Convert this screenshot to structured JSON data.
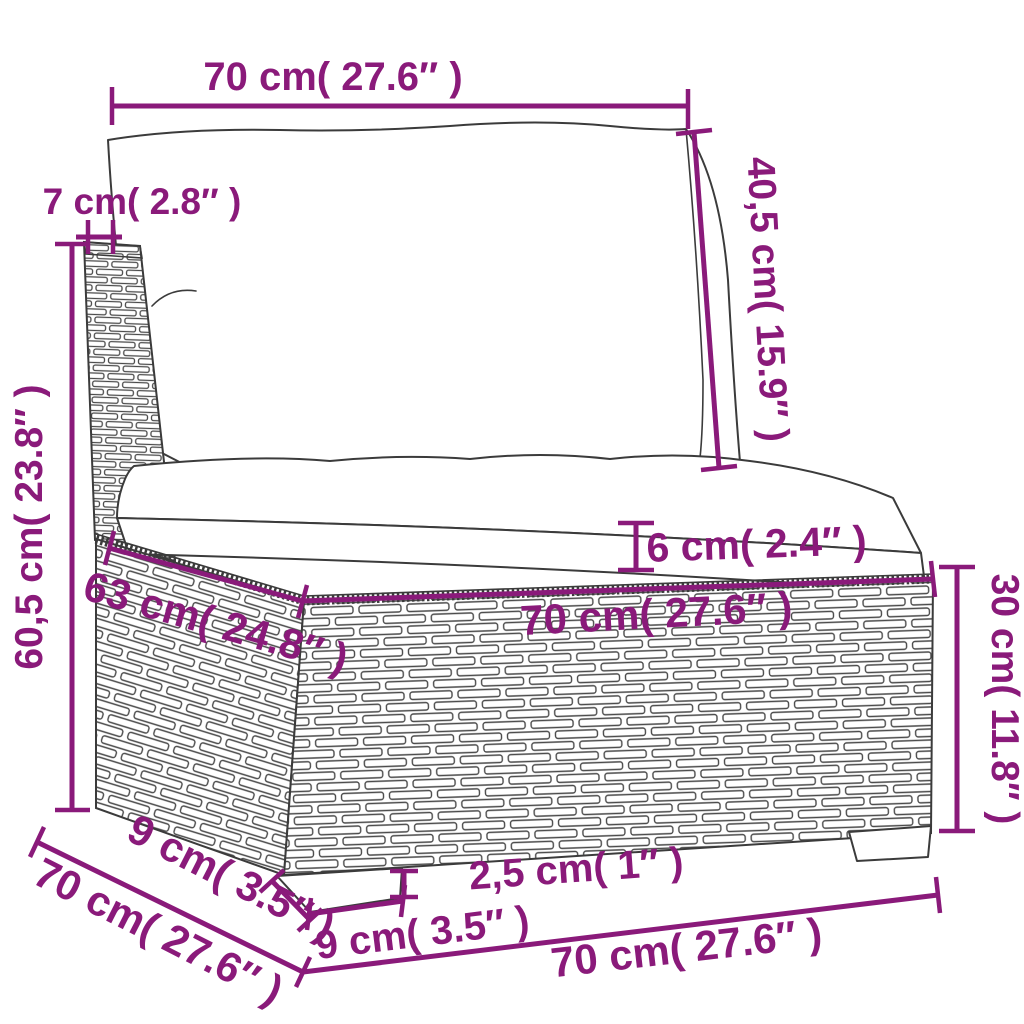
{
  "diagram": {
    "type": "furniture-dimension-diagram",
    "subject": "rattan garden sofa middle section with cushions",
    "units": [
      "cm",
      "inches"
    ],
    "colors": {
      "dimension_annotation": "#8a1a7a",
      "line_art": "#3b3b3b",
      "background": "#ffffff"
    }
  },
  "dimensions": {
    "top_width": {
      "label": "70 cm( 27.6″ )",
      "cm": "70",
      "inches": "27.6"
    },
    "back_height": {
      "label": "40,5 cm( 15.9″ )",
      "cm": "40,5",
      "inches": "15.9"
    },
    "post_width": {
      "label": "7 cm( 2.8″ )",
      "cm": "7",
      "inches": "2.8"
    },
    "total_height": {
      "label": "60,5 cm( 23.8″ )",
      "cm": "60,5",
      "inches": "23.8"
    },
    "cushion_thickness": {
      "label": "6 cm( 2.4″ )",
      "cm": "6",
      "inches": "2.4"
    },
    "seat_depth_top": {
      "label": "63 cm( 24.8″ )",
      "cm": "63",
      "inches": "24.8"
    },
    "base_width_top": {
      "label": "70 cm( 27.6″ )",
      "cm": "70",
      "inches": "27.6"
    },
    "base_height": {
      "label": "30 cm( 11.8″ )",
      "cm": "30",
      "inches": "11.8"
    },
    "leg_height": {
      "label": "2,5 cm( 1″ )",
      "cm": "2,5",
      "inches": "1"
    },
    "leg_width_front": {
      "label": "9 cm( 3.5″ )",
      "cm": "9",
      "inches": "3.5"
    },
    "leg_depth_side": {
      "label": "9 cm( 3.5″ )",
      "cm": "9",
      "inches": "3.5"
    },
    "side_depth_bottom": {
      "label": "70 cm( 27.6″ )",
      "cm": "70",
      "inches": "27.6"
    },
    "bottom_width": {
      "label": "70 cm( 27.6″ )",
      "cm": "70",
      "inches": "27.6"
    }
  }
}
